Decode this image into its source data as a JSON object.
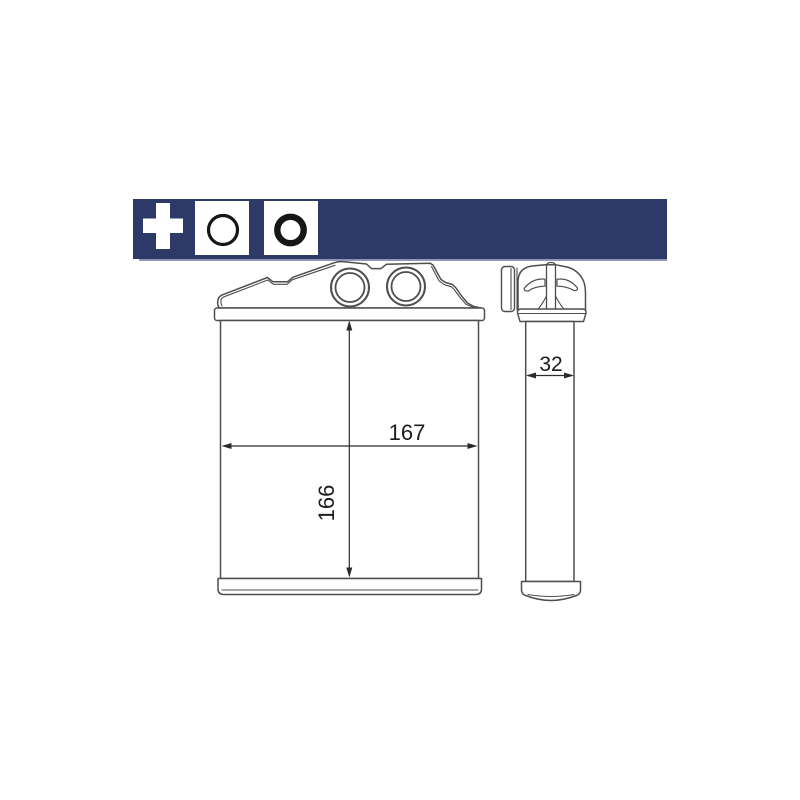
{
  "banner": {
    "bg_color": "#2d3966",
    "shadow_color": "#9096ba",
    "icons": [
      {
        "name": "plus-icon",
        "shape": "white-cross",
        "color": "#ffffff"
      },
      {
        "name": "thin-ring-icon",
        "shape": "circle-outline",
        "box_bg": "#ffffff",
        "stroke": "#161616"
      },
      {
        "name": "o-ring-icon",
        "shape": "thick-ring",
        "box_bg": "#ffffff",
        "stroke": "#161616"
      }
    ]
  },
  "diagram": {
    "kind": "technical-drawing",
    "subject": "heat exchanger / heater core, front view and side view",
    "line_color": "#4e4e4e",
    "dimension_color": "#2b2b2b",
    "dimensions": {
      "front_width": "167",
      "front_height": "166",
      "side_depth": "32"
    }
  }
}
